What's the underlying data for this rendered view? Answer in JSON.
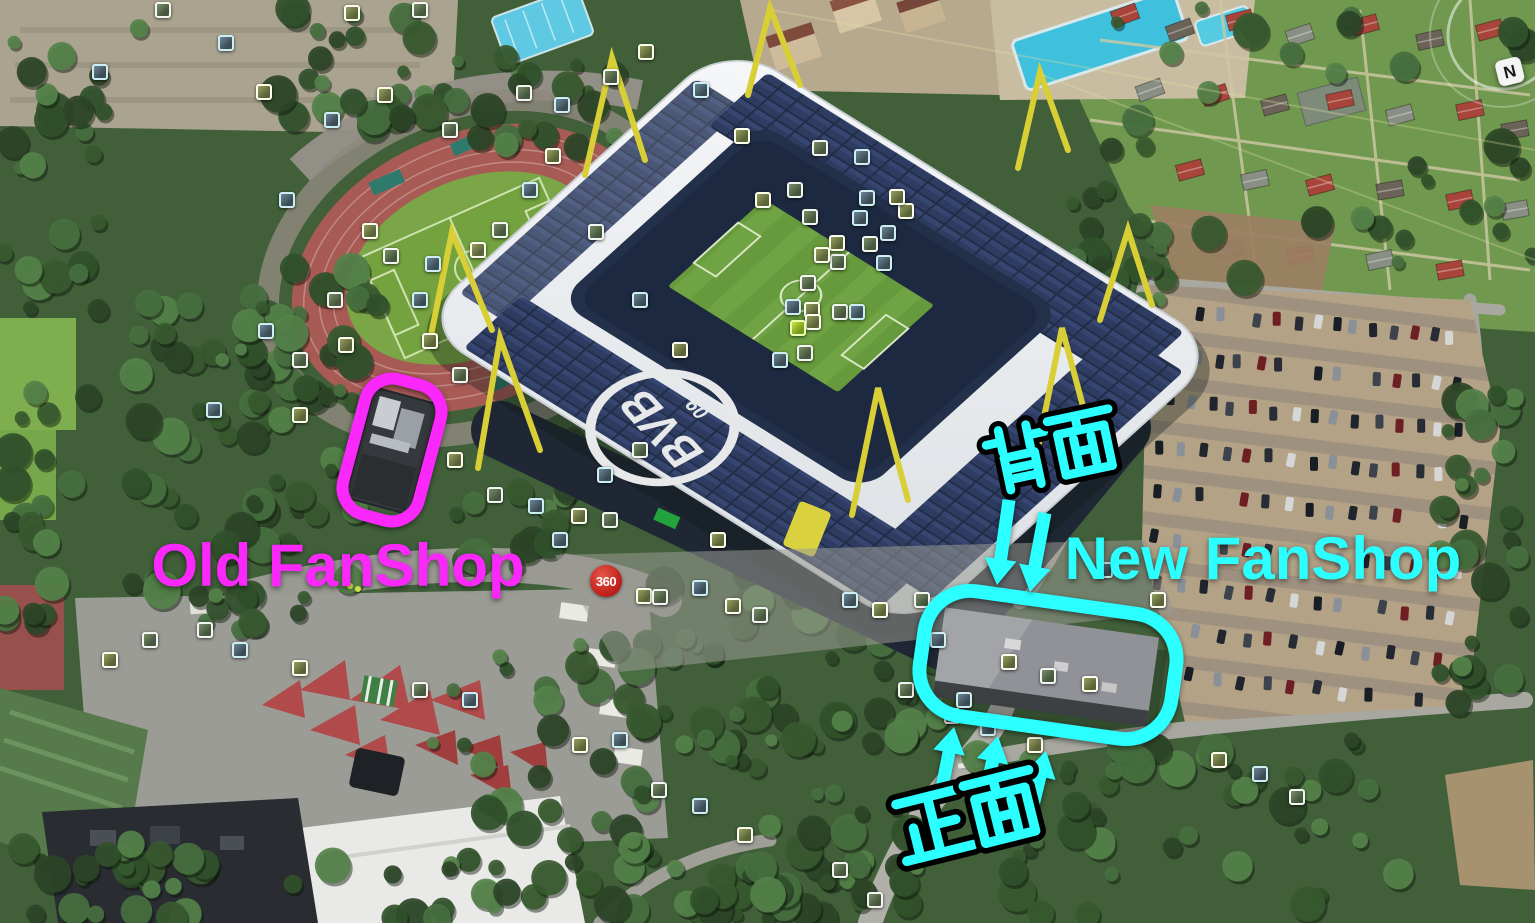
{
  "annotations": {
    "old_fanshop": {
      "label": "Old FanShop",
      "color": "#fb28fb"
    },
    "new_fanshop": {
      "label": "New FanShop",
      "color": "#2bffff"
    },
    "back_label": {
      "text": "背面",
      "color": "#2bffff",
      "pos": {
        "x": 975,
        "y": 428,
        "size": 74,
        "rot": -12,
        "spacing": 66
      }
    },
    "front_label": {
      "text": "正面",
      "color": "#2bffff",
      "pos": {
        "x": 884,
        "y": 796,
        "size": 80,
        "rot": -14,
        "spacing": 73
      }
    }
  },
  "badge_360": {
    "label": "360",
    "x": 606,
    "y": 581,
    "bg": "#c0211a",
    "fg": "#ffffff"
  },
  "compass": {
    "label": "N"
  },
  "overlays": {
    "old_outline": {
      "cx": 392,
      "cy": 450,
      "w": 78,
      "h": 140,
      "rx": 28,
      "rot": 15,
      "stroke": "#fb28fb",
      "sw": 12
    },
    "new_outline": {
      "cx": 1048,
      "cy": 665,
      "w": 254,
      "h": 126,
      "rx": 46,
      "rot": 8,
      "stroke": "#2bffff",
      "sw": 14
    },
    "down_arrows": [
      {
        "x1": 1009,
        "y1": 500,
        "x2": 997,
        "y2": 585
      },
      {
        "x1": 1045,
        "y1": 513,
        "x2": 1030,
        "y2": 592
      }
    ],
    "up_arrows": [
      {
        "x1": 941,
        "y1": 793,
        "x2": 954,
        "y2": 727
      },
      {
        "x1": 981,
        "y1": 815,
        "x2": 998,
        "y2": 736
      },
      {
        "x1": 1030,
        "y1": 818,
        "x2": 1046,
        "y2": 751
      }
    ]
  },
  "scene_colors": {
    "annotation_magenta": "#fb28fb",
    "annotation_cyan": "#2bffff",
    "badge_red": "#c0211a",
    "roof_white": "#eef0f2",
    "solar_panel": "#273350",
    "pitch_green": "#6fa343",
    "track_red": "#a85a55",
    "parking_tan": "#b3a286",
    "pylon_yellow": "#d8cf37"
  },
  "photo_markers": [
    [
      163,
      10
    ],
    [
      226,
      43
    ],
    [
      352,
      13
    ],
    [
      420,
      10
    ],
    [
      100,
      72
    ],
    [
      264,
      92
    ],
    [
      524,
      93
    ],
    [
      562,
      105
    ],
    [
      646,
      52
    ],
    [
      611,
      77
    ],
    [
      701,
      90
    ],
    [
      742,
      136
    ],
    [
      820,
      148
    ],
    [
      862,
      157
    ],
    [
      906,
      211
    ],
    [
      838,
      262
    ],
    [
      884,
      263
    ],
    [
      763,
      200
    ],
    [
      795,
      190
    ],
    [
      867,
      198
    ],
    [
      897,
      197
    ],
    [
      810,
      217
    ],
    [
      860,
      218
    ],
    [
      837,
      243
    ],
    [
      870,
      244
    ],
    [
      888,
      233
    ],
    [
      822,
      255
    ],
    [
      808,
      283
    ],
    [
      793,
      307
    ],
    [
      812,
      310
    ],
    [
      840,
      312
    ],
    [
      857,
      312
    ],
    [
      813,
      322
    ],
    [
      805,
      353
    ],
    [
      780,
      360
    ],
    [
      370,
      231
    ],
    [
      391,
      256
    ],
    [
      420,
      300
    ],
    [
      346,
      345
    ],
    [
      300,
      360
    ],
    [
      266,
      331
    ],
    [
      430,
      341
    ],
    [
      460,
      375
    ],
    [
      214,
      410
    ],
    [
      300,
      415
    ],
    [
      335,
      300
    ],
    [
      433,
      264
    ],
    [
      478,
      250
    ],
    [
      500,
      230
    ],
    [
      530,
      190
    ],
    [
      455,
      460
    ],
    [
      495,
      495
    ],
    [
      536,
      506
    ],
    [
      579,
      516
    ],
    [
      610,
      520
    ],
    [
      560,
      540
    ],
    [
      644,
      596
    ],
    [
      660,
      597
    ],
    [
      700,
      588
    ],
    [
      733,
      606
    ],
    [
      760,
      615
    ],
    [
      850,
      600
    ],
    [
      880,
      610
    ],
    [
      906,
      690
    ],
    [
      938,
      640
    ],
    [
      1009,
      662
    ],
    [
      1048,
      676
    ],
    [
      964,
      700
    ],
    [
      1090,
      684
    ],
    [
      659,
      790
    ],
    [
      700,
      806
    ],
    [
      745,
      835
    ],
    [
      952,
      716
    ],
    [
      988,
      728
    ],
    [
      1035,
      745
    ],
    [
      1297,
      797
    ],
    [
      1260,
      774
    ],
    [
      1219,
      760
    ],
    [
      840,
      870
    ],
    [
      620,
      740
    ],
    [
      580,
      745
    ],
    [
      205,
      630
    ],
    [
      240,
      650
    ],
    [
      300,
      668
    ],
    [
      420,
      690
    ],
    [
      470,
      700
    ],
    [
      110,
      660
    ],
    [
      150,
      640
    ],
    [
      1105,
      570
    ],
    [
      1158,
      600
    ],
    [
      875,
      900
    ],
    [
      332,
      120
    ],
    [
      385,
      95
    ],
    [
      450,
      130
    ],
    [
      287,
      200
    ],
    [
      553,
      156
    ],
    [
      596,
      232
    ],
    [
      640,
      300
    ],
    [
      680,
      350
    ],
    [
      640,
      450
    ],
    [
      605,
      475
    ],
    [
      718,
      540
    ],
    [
      922,
      600
    ]
  ],
  "pitch_marker": {
    "x": 798,
    "y": 328
  },
  "parking": {
    "car_colors": [
      "#191d24",
      "#272c35",
      "#3d434d",
      "#8a9097",
      "#d5d6d6",
      "#6e1f24",
      "#20242c"
    ],
    "rows": [
      {
        "x1": 1200,
        "y1": 312,
        "x2": 1452,
        "y2": 338,
        "n": 14
      },
      {
        "x1": 1180,
        "y1": 356,
        "x2": 1456,
        "y2": 386,
        "n": 15
      },
      {
        "x1": 1170,
        "y1": 400,
        "x2": 1460,
        "y2": 432,
        "n": 15
      },
      {
        "x1": 1162,
        "y1": 446,
        "x2": 1462,
        "y2": 478,
        "n": 15
      },
      {
        "x1": 1156,
        "y1": 492,
        "x2": 1464,
        "y2": 524,
        "n": 15
      },
      {
        "x1": 1152,
        "y1": 538,
        "x2": 1460,
        "y2": 570,
        "n": 14
      },
      {
        "x1": 1160,
        "y1": 584,
        "x2": 1452,
        "y2": 616,
        "n": 14
      },
      {
        "x1": 1172,
        "y1": 630,
        "x2": 1440,
        "y2": 660,
        "n": 12
      },
      {
        "x1": 1190,
        "y1": 676,
        "x2": 1420,
        "y2": 700,
        "n": 10
      }
    ]
  },
  "allotment_houses": {
    "roof_colors": [
      "#a8443a",
      "#6b6258",
      "#d8d4c8",
      "#8a8f85"
    ],
    "items": [
      [
        1125,
        15,
        -20,
        0
      ],
      [
        1180,
        30,
        -20,
        1
      ],
      [
        1240,
        20,
        -15,
        0
      ],
      [
        1300,
        35,
        -18,
        3
      ],
      [
        1365,
        25,
        -15,
        0
      ],
      [
        1430,
        40,
        -12,
        1
      ],
      [
        1490,
        30,
        -15,
        0
      ],
      [
        1150,
        90,
        -20,
        3
      ],
      [
        1215,
        95,
        -18,
        0
      ],
      [
        1275,
        105,
        -15,
        1
      ],
      [
        1340,
        100,
        -12,
        0
      ],
      [
        1400,
        115,
        -15,
        3
      ],
      [
        1470,
        110,
        -12,
        0
      ],
      [
        1515,
        130,
        -10,
        1
      ],
      [
        1190,
        170,
        -15,
        0
      ],
      [
        1255,
        180,
        -12,
        3
      ],
      [
        1320,
        185,
        -15,
        0
      ],
      [
        1390,
        190,
        -10,
        1
      ],
      [
        1460,
        200,
        -12,
        0
      ],
      [
        1515,
        210,
        -10,
        3
      ],
      [
        1230,
        250,
        -12,
        1
      ],
      [
        1300,
        255,
        -10,
        0
      ],
      [
        1380,
        260,
        -12,
        3
      ],
      [
        1450,
        270,
        -10,
        0
      ]
    ]
  }
}
